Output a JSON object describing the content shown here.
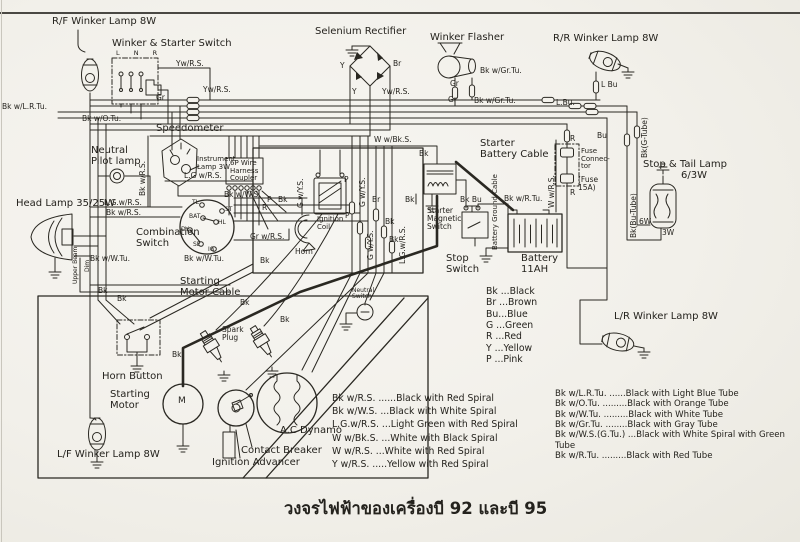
{
  "caption": "วงจรไฟฟ้าของเครื่องบี 92 และบี 95",
  "labels": {
    "components": {
      "rf_winker": "R/F Winker Lamp 8W",
      "winker_starter_switch": "Winker & Starter Switch",
      "switch_positions": "L N R",
      "selenium_rectifier": "Selenium Rectifier",
      "winker_flasher": "Winker Flasher",
      "rr_winker": "R/R Winker Lamp 8W",
      "speedometer": "Speedometer",
      "neutral_pilot_lamp": "Neutral\nPilot lamp",
      "instrument_lamp": "Instrument\nLamp 3W",
      "harness_coupler": "6P Wire\nHarness\nCoupler",
      "head_lamp": "Head Lamp 35/25W",
      "combination_switch": "Combination\nSwitch",
      "ignition_coil": "Ignition\nCoil",
      "horn": "Horn",
      "horn_button": "Horn Button",
      "starter_magnetic_switch": "Starter\nMagnetic\nSwitch",
      "starter_battery_cable": "Starter\nBattery Cable",
      "battery_ground_cable": "Battery Ground Cable",
      "battery": "Battery\n11AH",
      "stop_switch": "Stop\nSwitch",
      "fuse_connector": "Fuse\nConnec-\ntor",
      "fuse_rating": "(Fuse\n15A)",
      "stop_tail_lamp": "Stop & Tail Lamp",
      "stop_tail_rating": "6/3W",
      "starting_motor_cable": "Starting\nMotor Cable",
      "starting_motor": "Starting\n Motor",
      "motor_m": "M",
      "spark_plug": "Spark\nPlug",
      "contact_breaker": "Contact Breaker",
      "ignition_advancer": "Ignition Advancer",
      "ac_dynamo": "A.C Dynamo",
      "neutral_switch": "Neutral\nSwitch",
      "lf_winker": "L/F Winker Lamp 8W",
      "lr_winker": "L/R Winker Lamp 8W"
    },
    "wires": {
      "yw_rs_a": "Yw/R.S.",
      "yw_rs_b": "Yw/R.S.",
      "yw_rs_c": "Yw/R.S.",
      "gr_a": "Gr",
      "gr_b": "Gr",
      "gr_c": "Gr",
      "bk_lr_tu": "Bk w/L.R.Tu.",
      "bk_o_tu": "Bk w/O.Tu.",
      "y_a": "Y",
      "y_b": "Y",
      "br_a": "Br",
      "br_b": "Br",
      "bk_gr_tu_a": "Bk w/Gr.Tu.",
      "bk_gr_tu_b": "Bk w/Gr.Tu.",
      "l_bu_a": "L.Bu.",
      "l_bu_b": "L Bu",
      "bu_a": "Bu",
      "r_a": "R",
      "r_b": "R",
      "r_c": "R",
      "bk_g_tube": "Bk(G-Tube)",
      "bk_bu_tube": "Bk(Bu-Tube)",
      "w_6": "6W",
      "w_3": "3W",
      "w_bk_s": "W w/Bk.S.",
      "w_r_s": "W w/R.S.",
      "bk_a": "Bk",
      "bk_b": "Bk",
      "bk_c": "Bk",
      "bk_d": "Bk",
      "bk_e": "Bk",
      "bk_f": "Bk",
      "bk_g": "Bk",
      "bk_h": "Bk",
      "bk_i": "Bk",
      "bk_j": "Bk",
      "bk_k": "Bk",
      "bk_bu": "Bk Bu",
      "bk_r_tu": "Bk w/R.Tu.",
      "bk_rs_v": "Bk w/R.S.",
      "bk_rs_a": "Bk w/R.S.",
      "lg_rs_a": "L.G w/R.S.",
      "lg_rs_b": "L.G.w/R.S.",
      "lg_rs_v": "L.G.w/R.S.",
      "bk_ws_a": "Bk w/W.S.",
      "bk_wtu_a": "Bk w/W.Tu.",
      "bk_wtu_b": "Bk w/W.Tu.",
      "gr_rs": "Gr w/R.S.",
      "p_a": "P",
      "p_b": "P",
      "p_c": "P",
      "g_ys_a": "G w/Y.S.",
      "g_ys_b": "G w/Y.S.",
      "g_ys_c": "G w/Y.S.",
      "upper_beam": "Upper Beam",
      "dim": "Dim"
    },
    "terminals": {
      "tl": "TL",
      "st": "ST",
      "bat": "BAT",
      "hl": "HL",
      "dy": "DY",
      "se": "SE",
      "ig": "IG"
    }
  },
  "legend": {
    "colors": [
      "Bk ...Black",
      "Br ...Brown",
      "Bu...Blue",
      "G ...Green",
      "R  ...Red",
      "Y  ...Yellow",
      "P  ...Pink"
    ],
    "spirals": [
      "Bk w/R.S. ......Black with Red Spiral",
      "Bk w/W.S. ...Black with White Spiral",
      "L.G.w/R.S. ...Light Green with Red Spiral",
      "W w/Bk.S. ...White with Black Spiral",
      "W w/R.S. ...White with Red Spiral",
      "Y w/R.S. .....Yellow with Red Spiral"
    ],
    "tubes": [
      "Bk w/L.R.Tu. ......Black with Light Blue Tube",
      "Bk w/O.Tu. .........Black with Orange Tube",
      "Bk w/W.Tu. .........Black with White Tube",
      "Bk w/Gr.Tu. ........Black with Gray Tube",
      "Bk w/W.S.(G.Tu.) ...Black with White Spiral with Green Tube",
      "Bk w/R.Tu. .........Black with Red Tube"
    ]
  }
}
